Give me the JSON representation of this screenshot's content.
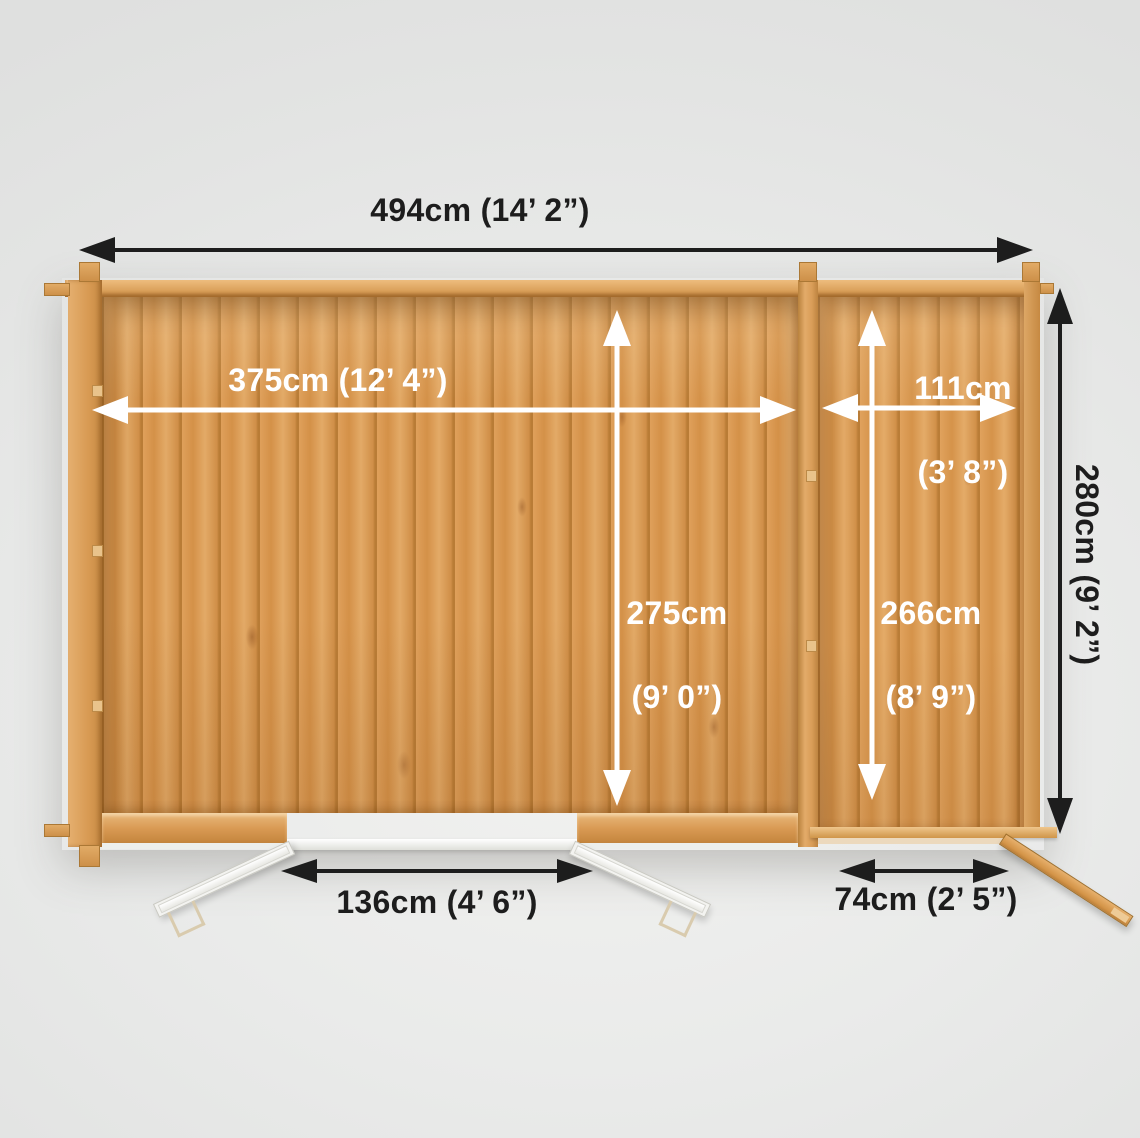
{
  "colors": {
    "background": "#e8e9e8",
    "wood": "#d79a52",
    "arrow_dark": "#1d1d1d",
    "arrow_light": "#ffffff"
  },
  "dimensions": {
    "overall_width": "494cm (14’ 2”)",
    "main_internal_width": "375cm (12’ 4”)",
    "main_internal_depth": {
      "cm": "275cm",
      "imperial": "(9’ 0”)"
    },
    "side_internal_width": {
      "cm": "111cm",
      "imperial": "(3’ 8”)"
    },
    "side_internal_depth": {
      "cm": "266cm",
      "imperial": "(8’ 9”)"
    },
    "overall_depth": "280cm (9’ 2”)",
    "main_door_width": "136cm (4’ 6”)",
    "side_door_width": "74cm (2’ 5”)"
  }
}
